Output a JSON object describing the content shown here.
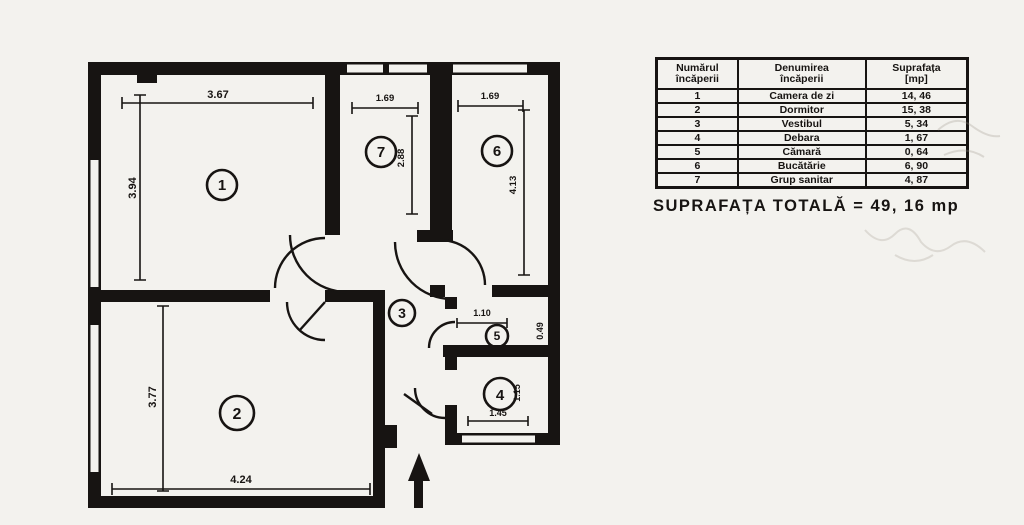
{
  "table": {
    "headers": [
      {
        "line1": "Numărul",
        "line2": "încăperii"
      },
      {
        "line1": "Denumirea",
        "line2": "încăperii"
      },
      {
        "line1": "Suprafața",
        "line2": "[mp]"
      }
    ],
    "rows": [
      {
        "nr": "1",
        "name": "Camera de zi",
        "area": "14, 46"
      },
      {
        "nr": "2",
        "name": "Dormitor",
        "area": "15, 38"
      },
      {
        "nr": "3",
        "name": "Vestibul",
        "area": "5, 34"
      },
      {
        "nr": "4",
        "name": "Debara",
        "area": "1, 67"
      },
      {
        "nr": "5",
        "name": "Cămară",
        "area": "0, 64"
      },
      {
        "nr": "6",
        "name": "Bucătărie",
        "area": "6, 90"
      },
      {
        "nr": "7",
        "name": "Grup sanitar",
        "area": "4, 87"
      }
    ],
    "total": "SUPRAFAȚA TOTALĂ = 49, 16 mp"
  },
  "plan": {
    "room_numbers": [
      "1",
      "2",
      "3",
      "4",
      "5",
      "6",
      "7"
    ],
    "dims": {
      "r1w": "3.67",
      "r1h": "3.94",
      "r2w": "4.24",
      "r2h": "3.77",
      "r7w": "1.69",
      "r7h": "2.88",
      "r6w": "1.69",
      "r6h": "4.13",
      "r5w": "1.10",
      "r5h": "0.49",
      "r4w": "1.45",
      "r4h": "1.15"
    },
    "colors": {
      "ink": "#171412",
      "paper": "#f3f2ee"
    }
  }
}
